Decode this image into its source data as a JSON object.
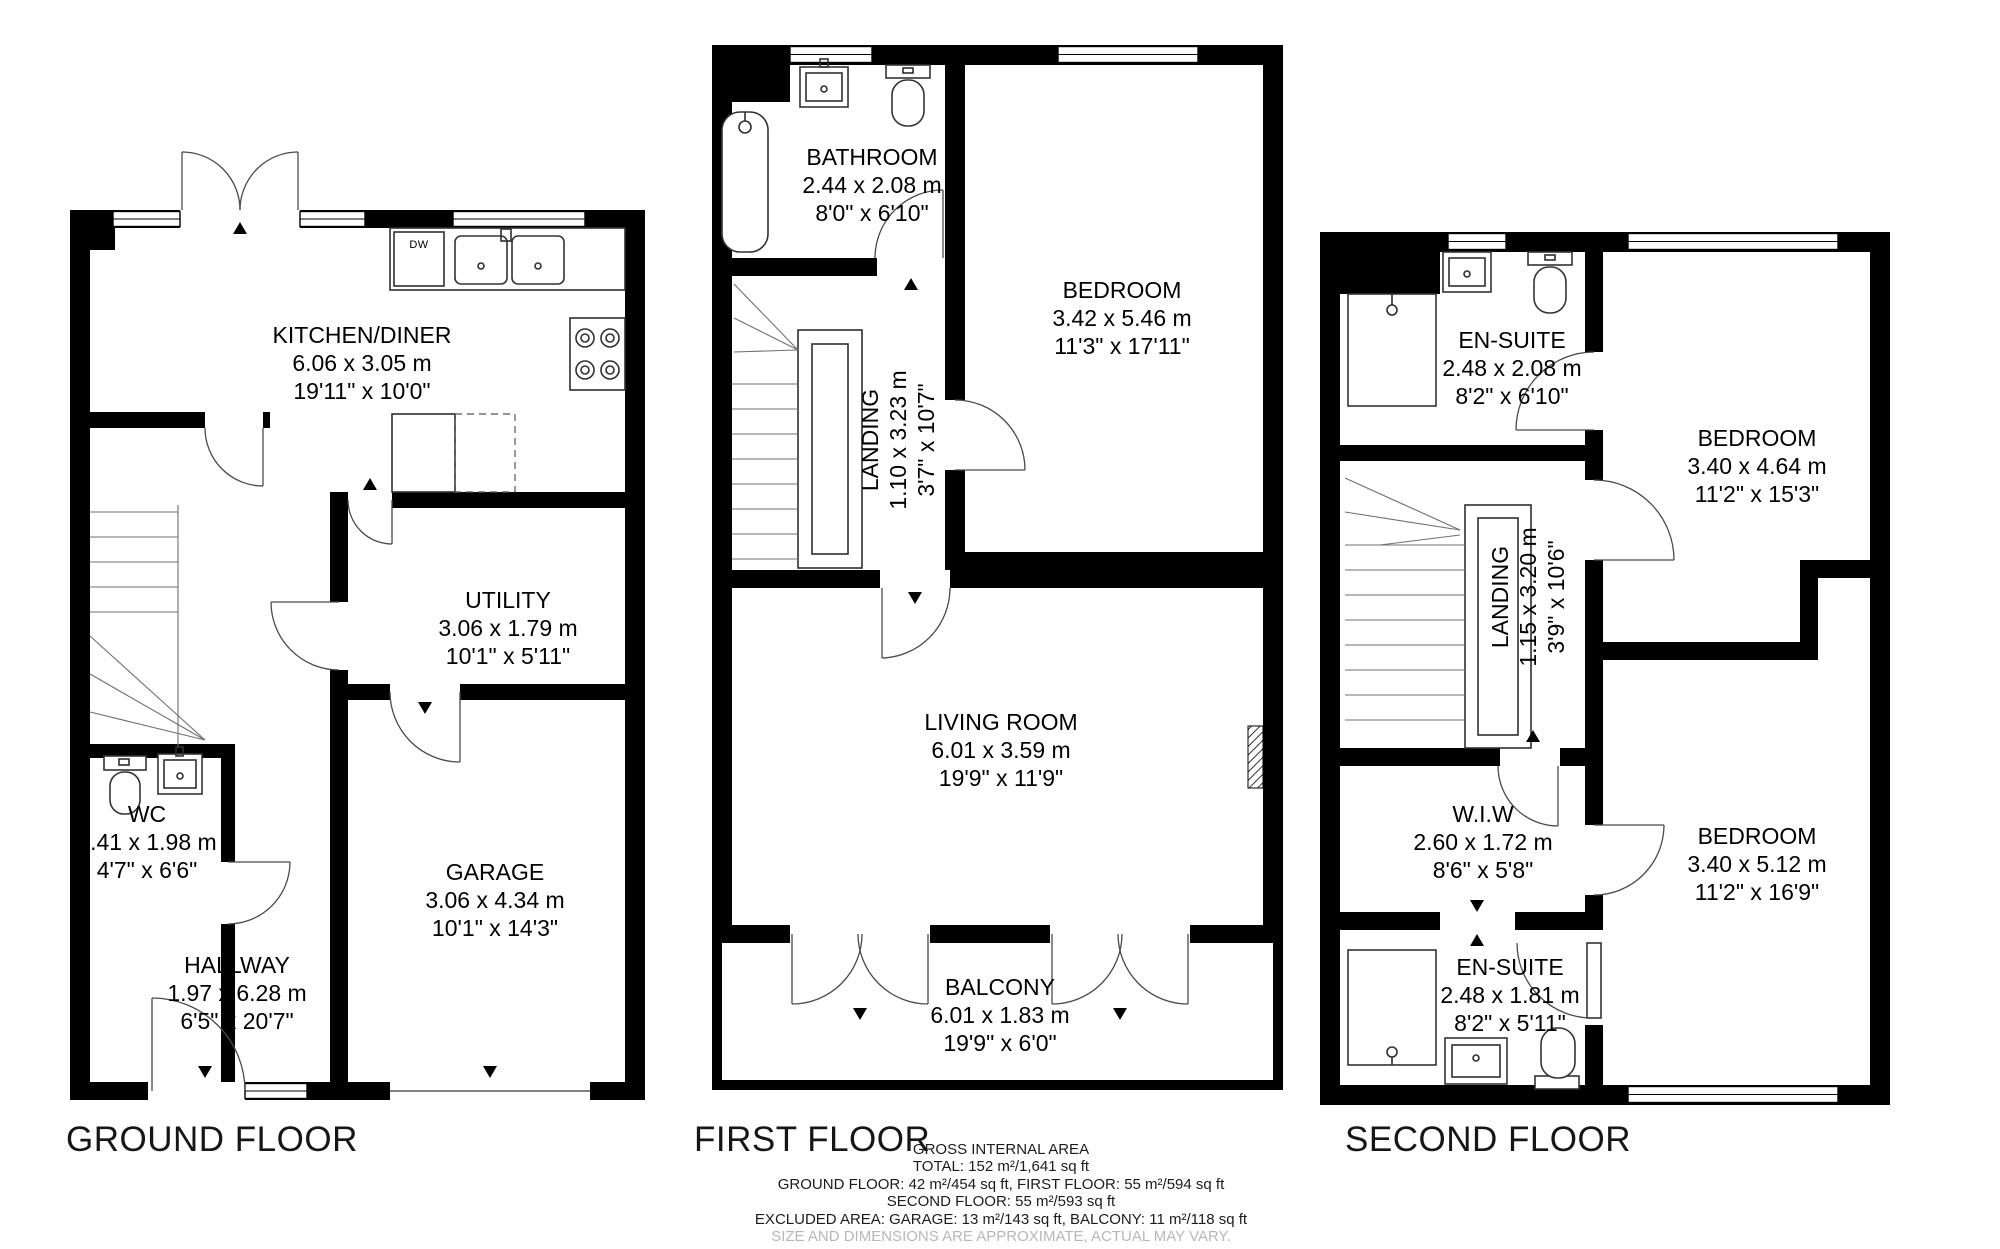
{
  "floors": [
    {
      "title": "GROUND FLOOR",
      "dw": "DW",
      "rooms": [
        {
          "name": "KITCHEN/DINER",
          "metric": "6.06 x 3.05 m",
          "imperial": "19'11\" x 10'0\""
        },
        {
          "name": "UTILITY",
          "metric": "3.06 x 1.79 m",
          "imperial": "10'1\" x 5'11\""
        },
        {
          "name": "WC",
          "metric": "1.41 x 1.98 m",
          "imperial": "4'7\" x 6'6\""
        },
        {
          "name": "HALLWAY",
          "metric": "1.97 x 6.28 m",
          "imperial": "6'5\" x 20'7\""
        },
        {
          "name": "GARAGE",
          "metric": "3.06 x 4.34 m",
          "imperial": "10'1\" x 14'3\""
        }
      ]
    },
    {
      "title": "FIRST FLOOR",
      "rooms": [
        {
          "name": "BATHROOM",
          "metric": "2.44 x 2.08 m",
          "imperial": "8'0\" x 6'10\""
        },
        {
          "name": "BEDROOM",
          "metric": "3.42 x 5.46 m",
          "imperial": "11'3\" x 17'11\""
        },
        {
          "name": "LANDING",
          "metric": "1.10 x 3.23 m",
          "imperial": "3'7\" x 10'7\""
        },
        {
          "name": "LIVING ROOM",
          "metric": "6.01 x 3.59 m",
          "imperial": "19'9\" x 11'9\""
        },
        {
          "name": "BALCONY",
          "metric": "6.01 x 1.83 m",
          "imperial": "19'9\" x 6'0\""
        }
      ]
    },
    {
      "title": "SECOND FLOOR",
      "rooms": [
        {
          "name": "EN-SUITE",
          "metric": "2.48 x 2.08 m",
          "imperial": "8'2\" x 6'10\""
        },
        {
          "name": "BEDROOM",
          "metric": "3.40 x 4.64 m",
          "imperial": "11'2\" x 15'3\""
        },
        {
          "name": "LANDING",
          "metric": "1.15 x 3.20 m",
          "imperial": "3'9\" x 10'6\""
        },
        {
          "name": "W.I.W",
          "metric": "2.60 x 1.72 m",
          "imperial": "8'6\" x 5'8\""
        },
        {
          "name": "EN-SUITE",
          "metric": "2.48 x 1.81 m",
          "imperial": "8'2\" x 5'11\""
        },
        {
          "name": "BEDROOM",
          "metric": "3.40 x 5.12 m",
          "imperial": "11'2\" x 16'9\""
        }
      ]
    }
  ],
  "footer": {
    "heading": "GROSS INTERNAL AREA",
    "total": "TOTAL: 152 m²/1,641 sq ft",
    "floors_line": "GROUND FLOOR: 42 m²/454 sq ft, FIRST FLOOR: 55 m²/594 sq ft",
    "second_line": "SECOND FLOOR: 55 m²/593 sq ft",
    "excluded_line": "EXCLUDED AREA: GARAGE: 13 m²/143 sq ft, BALCONY: 11 m²/118 sq ft",
    "disclaimer": "SIZE AND DIMENSIONS ARE APPROXIMATE, ACTUAL MAY VARY."
  },
  "colors": {
    "walls": "#000000",
    "text": "#000000",
    "disclaimer": "#b7b7b7",
    "background": "#ffffff"
  }
}
